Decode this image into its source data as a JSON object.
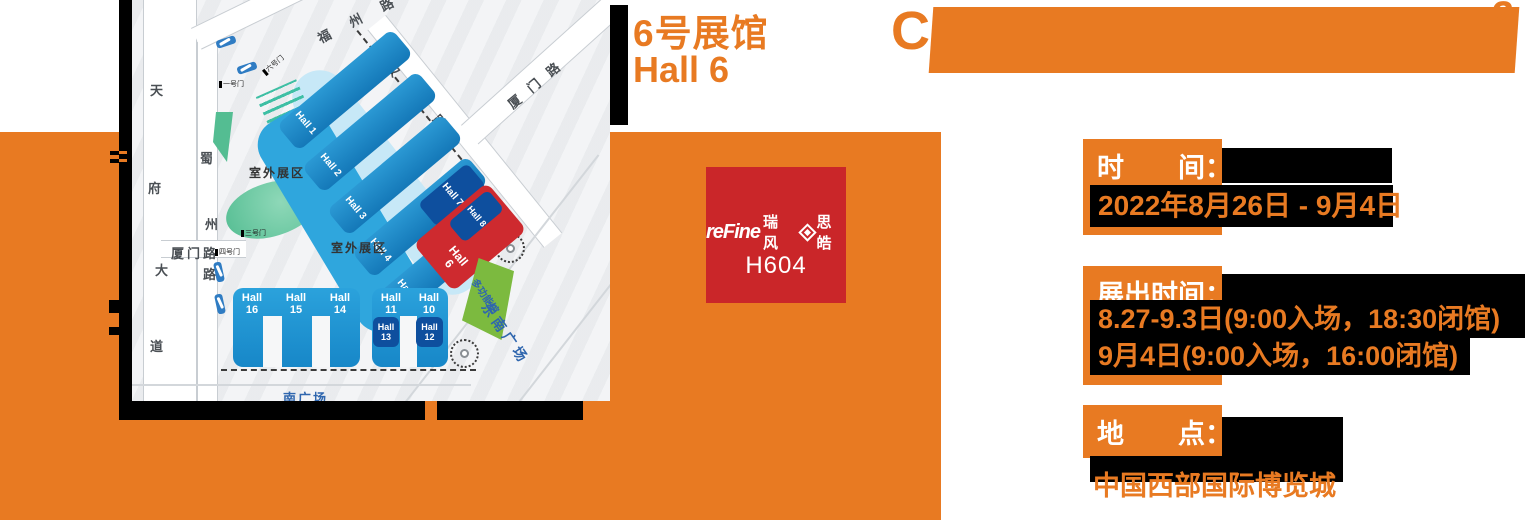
{
  "colors": {
    "accent_orange": "#E87A22",
    "badge_red": "#CA2629",
    "hall_red": "#CE2A2F",
    "hall_blue": "#1786C6",
    "hall_navy": "#0E4F9E",
    "black": "#000000"
  },
  "title": {
    "line1_cn": "6号展馆",
    "line2_en": "Hall 6"
  },
  "banner": {
    "fragment_c": "C",
    "fragment_2": "2"
  },
  "badge": {
    "brand_refine": "reFine",
    "brand_ruifeng": "瑞风",
    "brand_sehol": "思皓",
    "booth": "H604"
  },
  "info": {
    "sections": [
      {
        "label": "时　　间：",
        "values": [
          "2022年8月26日 - 9月4日"
        ]
      },
      {
        "label": "展出时间：",
        "values": [
          "8.27-9.3日(9:00入场，18:30闭馆)",
          "9月4日(9:00入场，16:00闭馆)"
        ]
      },
      {
        "label": "地　　点：",
        "values": [
          "中国西部国际博览城"
        ]
      }
    ]
  },
  "map": {
    "roads": {
      "tianfu": [
        "天",
        "府",
        "大",
        "道"
      ],
      "shuzhou": [
        "蜀",
        "州",
        "路"
      ],
      "xiamen_left": "厦门路",
      "fuzhou": "福州路",
      "hanzhou": "汉州路",
      "xiamen_right": "厦门路"
    },
    "areas": {
      "outdoor1": "室外展区",
      "outdoor2": "室外展区",
      "south_plaza": "南广场",
      "southeast_plaza": "东南广场",
      "multifunction": "多功能馆"
    },
    "gates": [
      "六号门",
      "一号门",
      "三号门",
      "四号门"
    ],
    "halls": {
      "h1": "Hall 1",
      "h2": "Hall 2",
      "h3": "Hall 3",
      "h4": "Hall 4",
      "h5": "Hall 5",
      "h6": "Hall 6",
      "h7": "Hall 7",
      "h8": "Hall 8",
      "h10": "Hall 10",
      "h11": "Hall 11",
      "h12": "Hall 12",
      "h13": "Hall 13",
      "h14": "Hall 14",
      "h15": "Hall 15",
      "h16": "Hall 16"
    }
  }
}
